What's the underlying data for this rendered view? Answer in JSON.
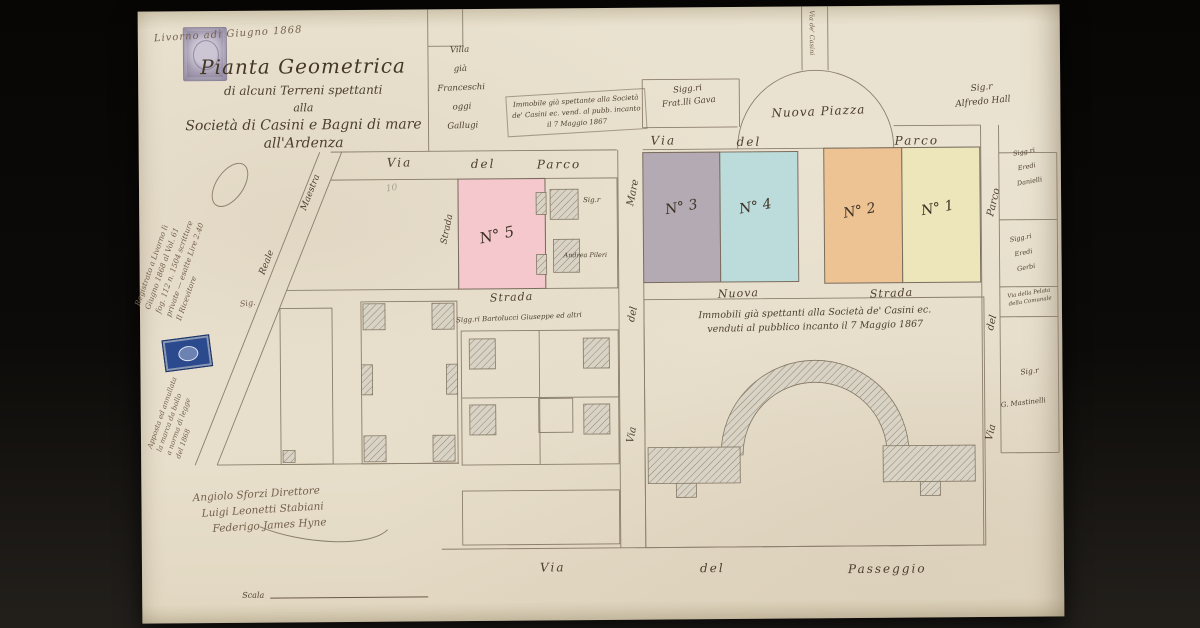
{
  "colors": {
    "paper": "#e9e1cf",
    "ink": "#4d3e2f",
    "line": "#8b7e6c",
    "plot_n1": "#ece6ba",
    "plot_n2": "#eec394",
    "plot_n3": "#b3aab3",
    "plot_n4": "#bcdcdb",
    "plot_n5": "#f4c8cd",
    "stamp_purple": "#a79fb4",
    "stamp_blue": "#2b4a8e"
  },
  "header": {
    "date_line": "Livorno adì Giugno 1868",
    "title_lines": [
      "Pianta Geometrica",
      "di alcuni Terreni spettanti",
      "alla",
      "Società di Casini e Bagni di mare",
      "all'Ardenza"
    ]
  },
  "margin_notes": {
    "registration_lines": [
      "Registrato a Livorno lì",
      "Giugno 1868 al Vol. 61",
      "fog. 112 n. 1504 scritture",
      "private — esatte Lire 2.40",
      "Il Ricevitore"
    ],
    "stamp_note_lines": [
      "Apposta ed annullata",
      "la marca da bollo",
      "a norma di legge",
      "del 1868"
    ],
    "sig_left": "Sig."
  },
  "streets": {
    "parco_upper_left": [
      "Via",
      "del",
      "Parco"
    ],
    "parco_upper_right": [
      "Via",
      "del",
      "Parco"
    ],
    "mare_vertical": [
      "Mare",
      "del",
      "Via"
    ],
    "parco_vertical": [
      "Parco",
      "del",
      "Via"
    ],
    "nuova_row": [
      "Strada",
      "Nuova",
      "Strada"
    ],
    "passeggio": [
      "Via",
      "del",
      "Passeggio"
    ],
    "diagonal": [
      "Maestra",
      "Reale"
    ],
    "strada_vertical": "Strada",
    "casini_vertical": "Via de' Casini",
    "pelata_lines": [
      "Via della Pelata",
      "della Comunale"
    ]
  },
  "map": {
    "piazza_label": "Nuova Piazza"
  },
  "plots": {
    "n1": "N° 1",
    "n2": "N° 2",
    "n3": "N° 3",
    "n4": "N° 4",
    "n5": "N° 5",
    "pencil_note": "10"
  },
  "owners": {
    "villa_lines": [
      "Villa",
      "già",
      "Franceschi",
      "oggi",
      "Gallugi"
    ],
    "frat_lines": [
      "Sigg.ri",
      "Frat.lli Gava"
    ],
    "hall_lines": [
      "Sig.r",
      "Alfredo Hall"
    ],
    "eredi1_lines": [
      "Sigg.ri",
      "Eredi",
      "Danielli"
    ],
    "eredi2_lines": [
      "Sigg.ri",
      "Eredi",
      "Gerbi"
    ],
    "mastini_lines": [
      "Sig.r",
      "G. Mastinelli"
    ],
    "sig_square": "Sig.r",
    "andrea": "Andrea Pileri",
    "bartolucci": "Sigg.ri Bartolucci Giuseppe ed altri"
  },
  "notes": {
    "sold_small_lines": [
      "Immobile già spettante alla Società",
      "de' Casini ec. vend. al pubb. incanto",
      "il 7 Maggio 1867"
    ],
    "sold_large_lines": [
      "Immobili già spettanti alla Società de' Casini ec.",
      "venduti al pubblico incanto il 7 Maggio 1867"
    ]
  },
  "signatures": [
    "Angiolo Sforzi Direttore",
    "Luigi Leonetti Stabiani",
    "Federigo James Hyne"
  ],
  "scale_label": "Scala"
}
